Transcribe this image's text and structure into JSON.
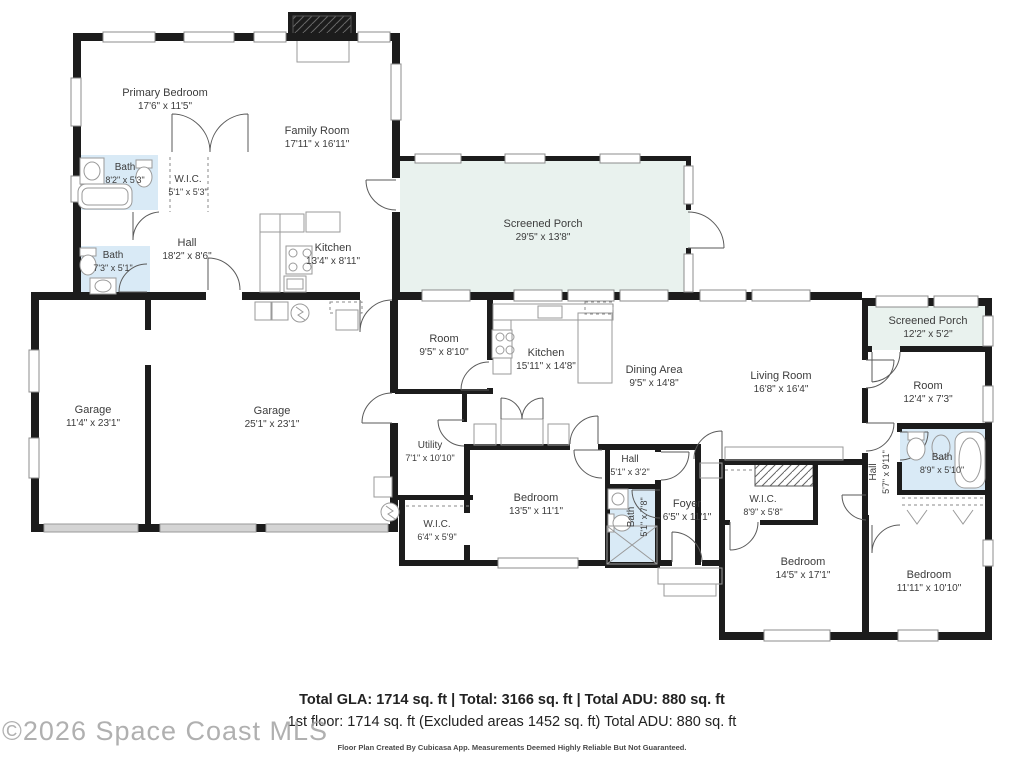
{
  "colors": {
    "wall": "#1c1c1c",
    "porch_fill": "#e9f2ee",
    "bath_fill": "#d9eaf6",
    "garage_door_fill": "#d4d4d4",
    "label_text": "#3c3c3c",
    "footer_text": "#222222",
    "watermark_text": "#a3a3a3"
  },
  "rooms": [
    {
      "name": "Primary Bedroom",
      "dims": "17'6\" x 11'5\""
    },
    {
      "name": "Family Room",
      "dims": "17'11\" x 16'11\""
    },
    {
      "name": "Bath",
      "dims": "8'2\" x 5'3\""
    },
    {
      "name": "W.I.C.",
      "dims": "5'1\" x 5'3\""
    },
    {
      "name": "Bath",
      "dims": "7'3\" x 5'1\""
    },
    {
      "name": "Hall",
      "dims": "18'2\" x 8'6\""
    },
    {
      "name": "Kitchen",
      "dims": "13'4\" x 8'11\""
    },
    {
      "name": "Screened Porch",
      "dims": "29'5\" x 13'8\""
    },
    {
      "name": "Garage",
      "dims": "11'4\" x 23'1\""
    },
    {
      "name": "Garage",
      "dims": "25'1\" x 23'1\""
    },
    {
      "name": "Room",
      "dims": "9'5\" x 8'10\""
    },
    {
      "name": "Kitchen",
      "dims": "15'11\" x 14'8\""
    },
    {
      "name": "Dining Area",
      "dims": "9'5\" x 14'8\""
    },
    {
      "name": "Living Room",
      "dims": "16'8\" x 16'4\""
    },
    {
      "name": "Screened Porch",
      "dims": "12'2\" x 5'2\""
    },
    {
      "name": "Room",
      "dims": "12'4\" x 7'3\""
    },
    {
      "name": "Bath",
      "dims": "8'9\" x 5'10\""
    },
    {
      "name": "Hall",
      "dims": "5'7\" x 9'11\""
    },
    {
      "name": "Utility",
      "dims": "7'1\" x 10'10\""
    },
    {
      "name": "W.I.C.",
      "dims": "6'4\" x 5'9\""
    },
    {
      "name": "Bedroom",
      "dims": "13'5\" x 11'1\""
    },
    {
      "name": "Hall",
      "dims": "5'1\" x 3'2\""
    },
    {
      "name": "Bath",
      "dims": "5'1\" x 7'8\""
    },
    {
      "name": "Foyer",
      "dims": "6'5\" x 11'1\""
    },
    {
      "name": "W.I.C.",
      "dims": "8'9\" x 5'8\""
    },
    {
      "name": "Bedroom",
      "dims": "14'5\" x 17'1\""
    },
    {
      "name": "Bedroom",
      "dims": "11'11\" x 10'10\""
    }
  ],
  "footer": {
    "line1": "Total GLA: 1714 sq. ft | Total: 3166 sq. ft | Total ADU: 880 sq. ft",
    "line2": "1st floor: 1714 sq. ft (Excluded areas 1452 sq. ft) Total ADU: 880 sq. ft",
    "line3": "Floor Plan Created By Cubicasa App. Measurements Deemed Highly Reliable But Not Guaranteed."
  },
  "watermark": "©2026 Space Coast MLS"
}
